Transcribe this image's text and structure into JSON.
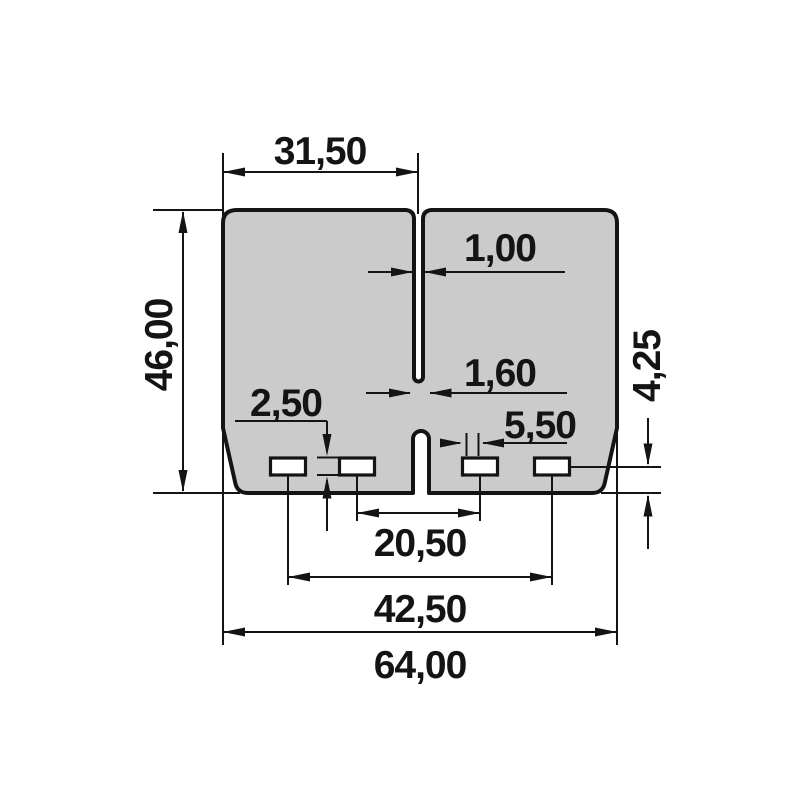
{
  "drawing": {
    "kind": "technical-dimension-drawing",
    "part": "reed-valve-petal-pair",
    "units_style": "comma-decimal-millimeters",
    "colors": {
      "background": "#ffffff",
      "part_fill": "#cbcbcb",
      "slot_fill": "#ffffff",
      "line": "#141414"
    },
    "dimensions": {
      "top_half_width": {
        "label": "31,50",
        "measures": "left edge to center slit",
        "orientation": "horizontal"
      },
      "overall_height": {
        "label": "46,00",
        "measures": "overall petal height",
        "orientation": "vertical"
      },
      "top_slit_width": {
        "label": "1,00",
        "measures": "upper center slit width",
        "orientation": "horizontal"
      },
      "bottom_slit_width": {
        "label": "1,60",
        "measures": "lower center slit width",
        "orientation": "horizontal"
      },
      "slot_height": {
        "label": "2,50",
        "measures": "slot height",
        "orientation": "vertical"
      },
      "slot_width": {
        "label": "5,50",
        "measures": "slot width",
        "orientation": "horizontal"
      },
      "slot_center_to_bottom": {
        "label": "4,25",
        "measures": "slot center line to bottom edge",
        "orientation": "vertical"
      },
      "inner_slot_centers": {
        "label": "20,50",
        "measures": "distance between inner slot centers",
        "orientation": "horizontal"
      },
      "outer_slot_centers": {
        "label": "42,50",
        "measures": "distance between outer slot centers",
        "orientation": "horizontal"
      },
      "overall_width": {
        "label": "64,00",
        "measures": "overall petal width",
        "orientation": "horizontal"
      }
    }
  }
}
